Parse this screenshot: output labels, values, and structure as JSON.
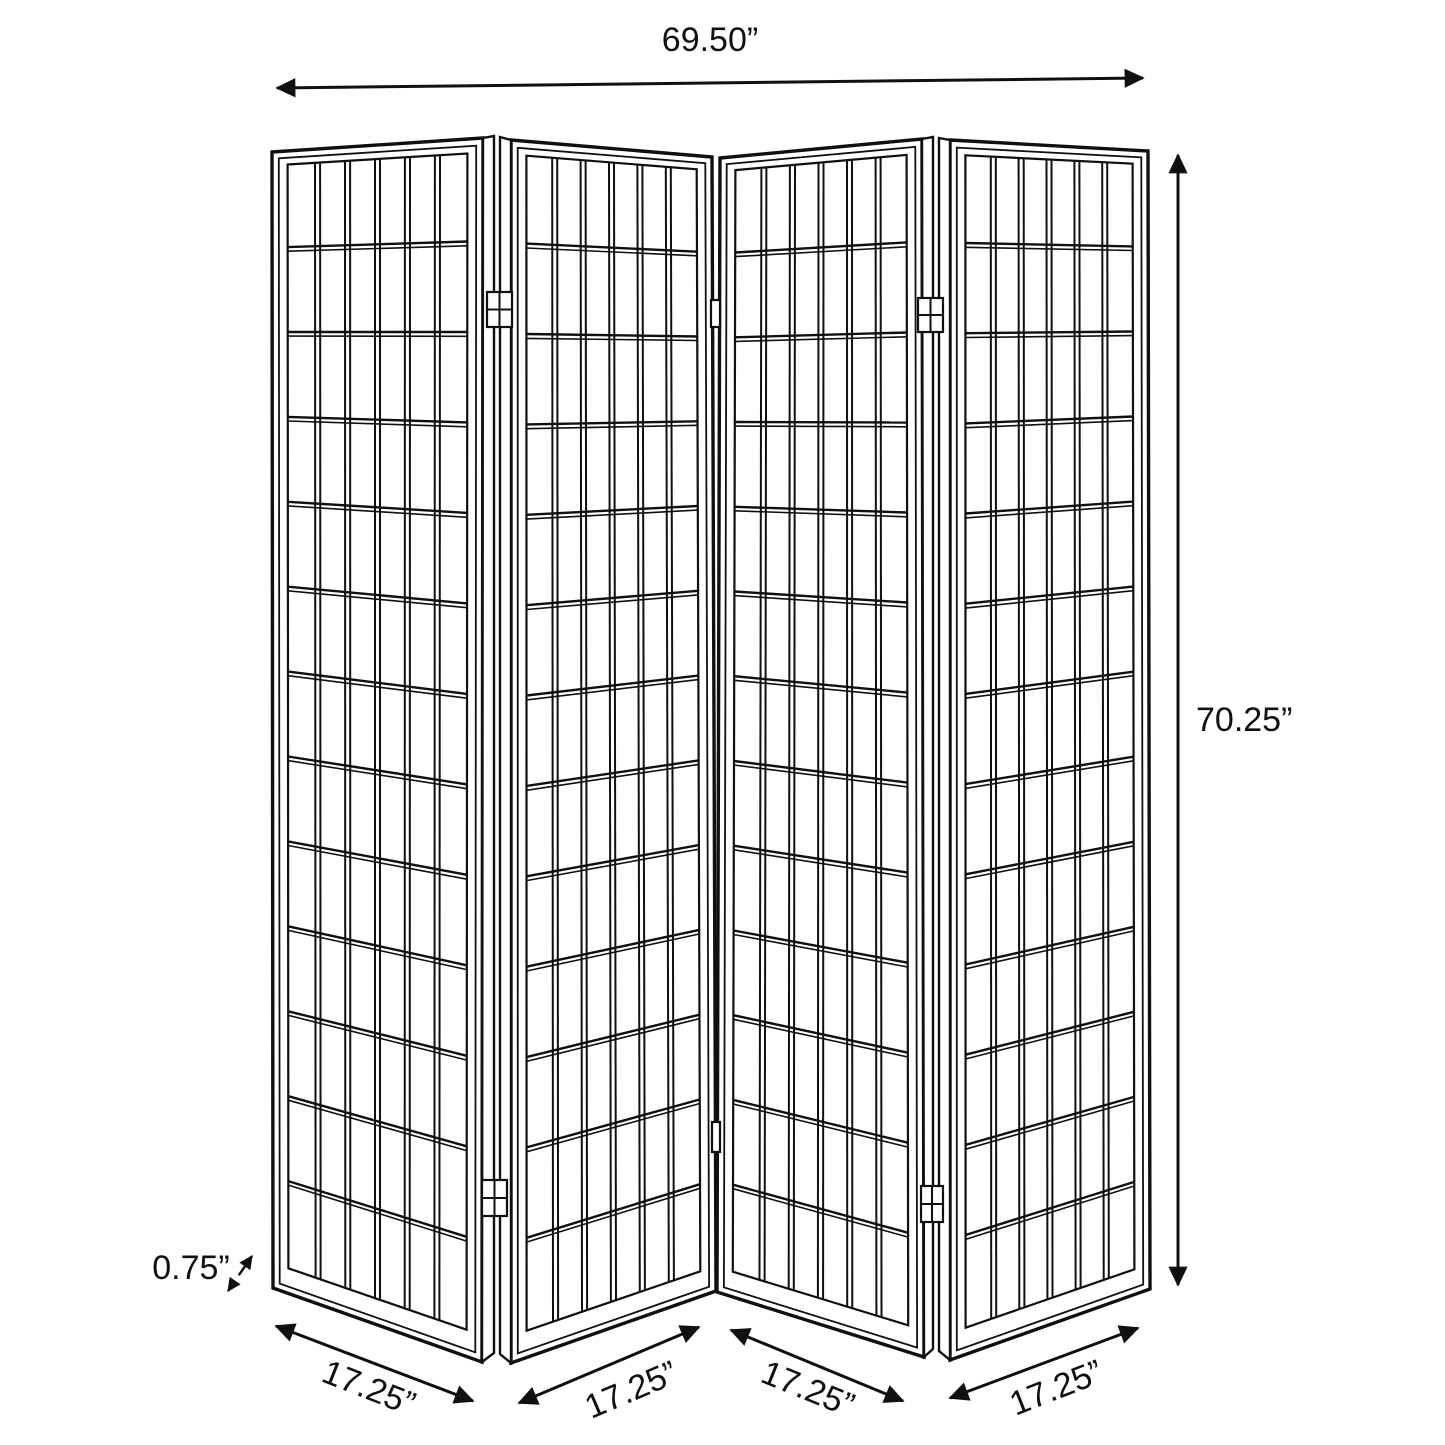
{
  "figure": {
    "description": "4-panel folding shoji room divider screen dimension diagram",
    "colors": {
      "ink": "#101010",
      "paper": "#ffffff"
    },
    "font_size": 34,
    "grid": {
      "columns": 6,
      "rows": 13
    },
    "frame": {
      "outer_stroke": 3.4,
      "inner_inset": 7,
      "grid_inset": {
        "left": 16,
        "right": 16,
        "top": 14,
        "bottom": 26
      }
    },
    "panels": [
      {
        "name": "panel-1",
        "tl": [
          272,
          152
        ],
        "tr": [
          483,
          138
        ],
        "br": [
          482,
          1362
        ],
        "bl": [
          273,
          1288
        ]
      },
      {
        "name": "panel-2",
        "tl": [
          511,
          140
        ],
        "tr": [
          712,
          157
        ],
        "br": [
          716,
          1291
        ],
        "bl": [
          511,
          1363
        ]
      },
      {
        "name": "panel-3",
        "tl": [
          720,
          158
        ],
        "tr": [
          922,
          139
        ],
        "br": [
          924,
          1357
        ],
        "bl": [
          717,
          1292
        ]
      },
      {
        "name": "panel-4",
        "tl": [
          950,
          140
        ],
        "tr": [
          1148,
          151
        ],
        "br": [
          1150,
          1289
        ],
        "bl": [
          950,
          1360
        ]
      }
    ],
    "edge_strips": [
      {
        "pts": [
          [
            483,
            138
          ],
          [
            494,
            136
          ],
          [
            494,
            1353
          ],
          [
            482,
            1362
          ]
        ]
      },
      {
        "pts": [
          [
            500,
            137
          ],
          [
            511,
            140
          ],
          [
            511,
            1363
          ],
          [
            500,
            1354
          ]
        ]
      },
      {
        "pts": [
          [
            922,
            139
          ],
          [
            933,
            137
          ],
          [
            933,
            1349
          ],
          [
            924,
            1357
          ]
        ]
      },
      {
        "pts": [
          [
            939,
            138
          ],
          [
            950,
            140
          ],
          [
            950,
            1360
          ],
          [
            939,
            1351
          ]
        ]
      }
    ],
    "hinges": [
      {
        "x": 487,
        "y": 292,
        "w": 25,
        "h": 35,
        "cross": true
      },
      {
        "x": 482,
        "y": 1180,
        "w": 25,
        "h": 36,
        "cross": true
      },
      {
        "x": 711,
        "y": 300,
        "w": 9,
        "h": 27,
        "cross": false
      },
      {
        "x": 712,
        "y": 1122,
        "w": 8,
        "h": 30,
        "cross": false
      },
      {
        "x": 918,
        "y": 298,
        "w": 25,
        "h": 34,
        "cross": true
      },
      {
        "x": 921,
        "y": 1186,
        "w": 22,
        "h": 36,
        "cross": true
      }
    ],
    "dimensions": [
      {
        "id": "overall-width",
        "label": "69.50”",
        "x1": 277,
        "y1": 88,
        "x2": 1143,
        "y2": 78,
        "lx": 710,
        "ly": 42,
        "rot": 0,
        "anchor": "middle",
        "small": false
      },
      {
        "id": "overall-height",
        "label": "70.25”",
        "x1": 1178,
        "y1": 155,
        "x2": 1178,
        "y2": 1285,
        "lx": 1196,
        "ly": 722,
        "rot": 0,
        "anchor": "start",
        "small": false
      },
      {
        "id": "panel-1-width",
        "label": "17.25”",
        "x1": 276,
        "y1": 1326,
        "x2": 473,
        "y2": 1401,
        "lx": 368,
        "ly": 1390,
        "rot": 21.5,
        "anchor": "middle",
        "small": false
      },
      {
        "id": "panel-2-width",
        "label": "17.25”",
        "x1": 519,
        "y1": 1403,
        "x2": 699,
        "y2": 1327,
        "lx": 632,
        "ly": 1392,
        "rot": -23,
        "anchor": "middle",
        "small": false
      },
      {
        "id": "panel-3-width",
        "label": "17.25”",
        "x1": 731,
        "y1": 1330,
        "x2": 903,
        "y2": 1401,
        "lx": 807,
        "ly": 1391,
        "rot": 22,
        "anchor": "middle",
        "small": false
      },
      {
        "id": "panel-4-width",
        "label": "17.25”",
        "x1": 950,
        "y1": 1398,
        "x2": 1138,
        "y2": 1328,
        "lx": 1057,
        "ly": 1390,
        "rot": -21.5,
        "anchor": "middle",
        "small": false
      },
      {
        "id": "panel-thickness",
        "label": "0.75”",
        "x1": 228,
        "y1": 1291,
        "x2": 252,
        "y2": 1256,
        "lx": 191,
        "ly": 1270,
        "rot": 0,
        "anchor": "middle",
        "small": true
      }
    ],
    "stated_dimensions": {
      "overall_width_in": 69.5,
      "overall_height_in": 70.25,
      "panel_width_in": 17.25,
      "panel_thickness_in": 0.75,
      "panel_count": 4
    }
  }
}
